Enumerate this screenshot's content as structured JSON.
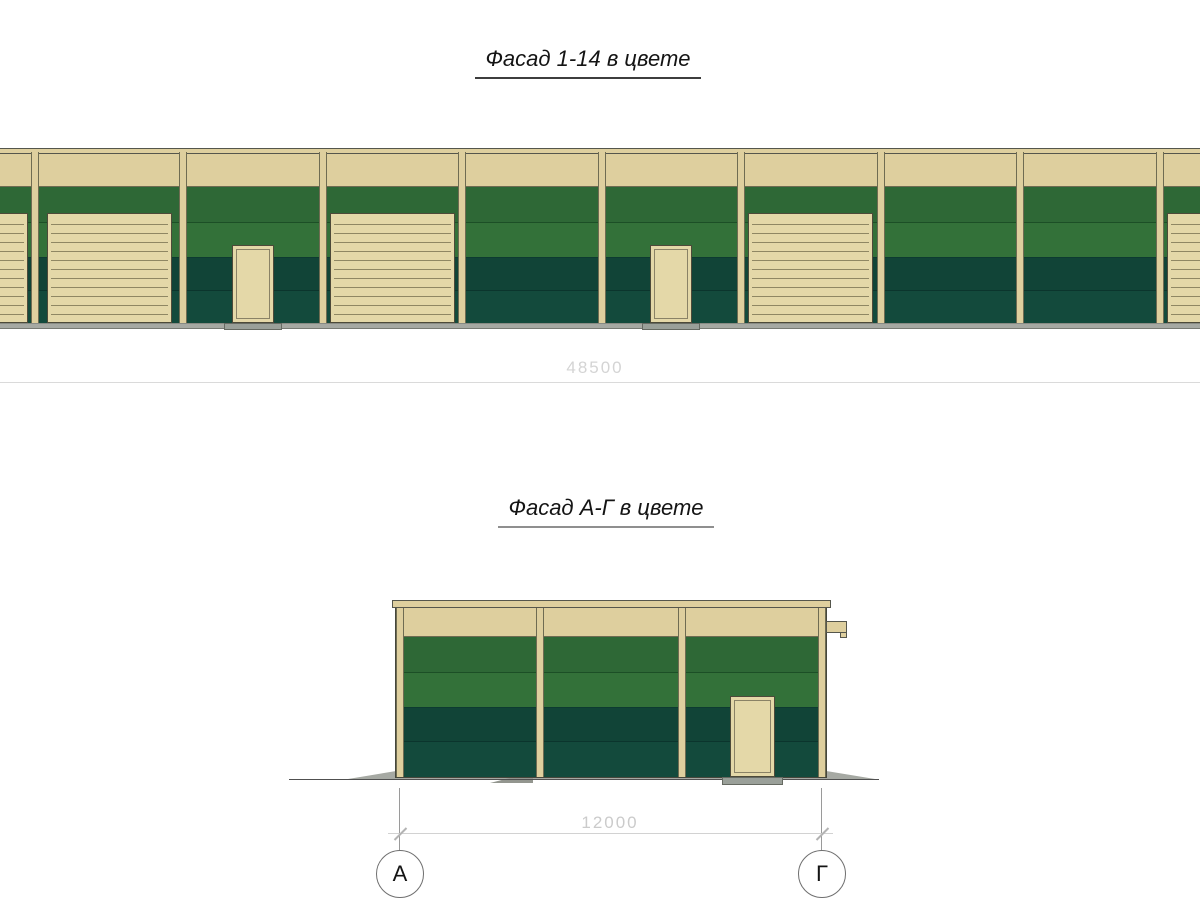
{
  "drawing": {
    "titles": {
      "facade_1_14": "Фасад 1-14 в цвете",
      "facade_a_g": "Фасад А-Г в цвете"
    },
    "dimensions": {
      "facade_1_14_length": "48500",
      "facade_a_g_width": "12000"
    },
    "axis_markers": {
      "left": "А",
      "right": "Г"
    },
    "colors": {
      "cream": "#decf9e",
      "cream_door": "#e4d8a8",
      "cream_edge": "#6f6c52",
      "coping_edge": "#55564c",
      "green_mid_upper": "#2e6836",
      "green_mid_lower": "#337139",
      "green_dark_upper": "#114437",
      "green_dark_lower": "#134a3c",
      "joint_mid": "#1c4f26",
      "joint_mid_dark_boundary": "#0d3b31",
      "joint_dark": "#0b352d",
      "wall_outline": "#46473c",
      "door_outline": "#4d4a39",
      "door_frame_inner": "#8a8266",
      "slat_line": "#8f8763",
      "plinth_gray": "#a6a9a3",
      "plinth_edge_top": "#888b84",
      "plinth_edge_bottom": "#777a73",
      "apron_gray": "#a6a9a3",
      "apron_gray_dark": "#93968f",
      "threshold_gray": "#9aa099",
      "threshold_edge": "#666a62",
      "ground_line": "#505050"
    },
    "facade_1_14": {
      "bays": [
        "garage",
        "garage",
        "person",
        "garage",
        "empty",
        "person",
        "garage",
        "empty",
        "empty",
        "garage"
      ]
    },
    "facade_a_g": {
      "bays": [
        "empty",
        "empty",
        "person"
      ]
    }
  }
}
